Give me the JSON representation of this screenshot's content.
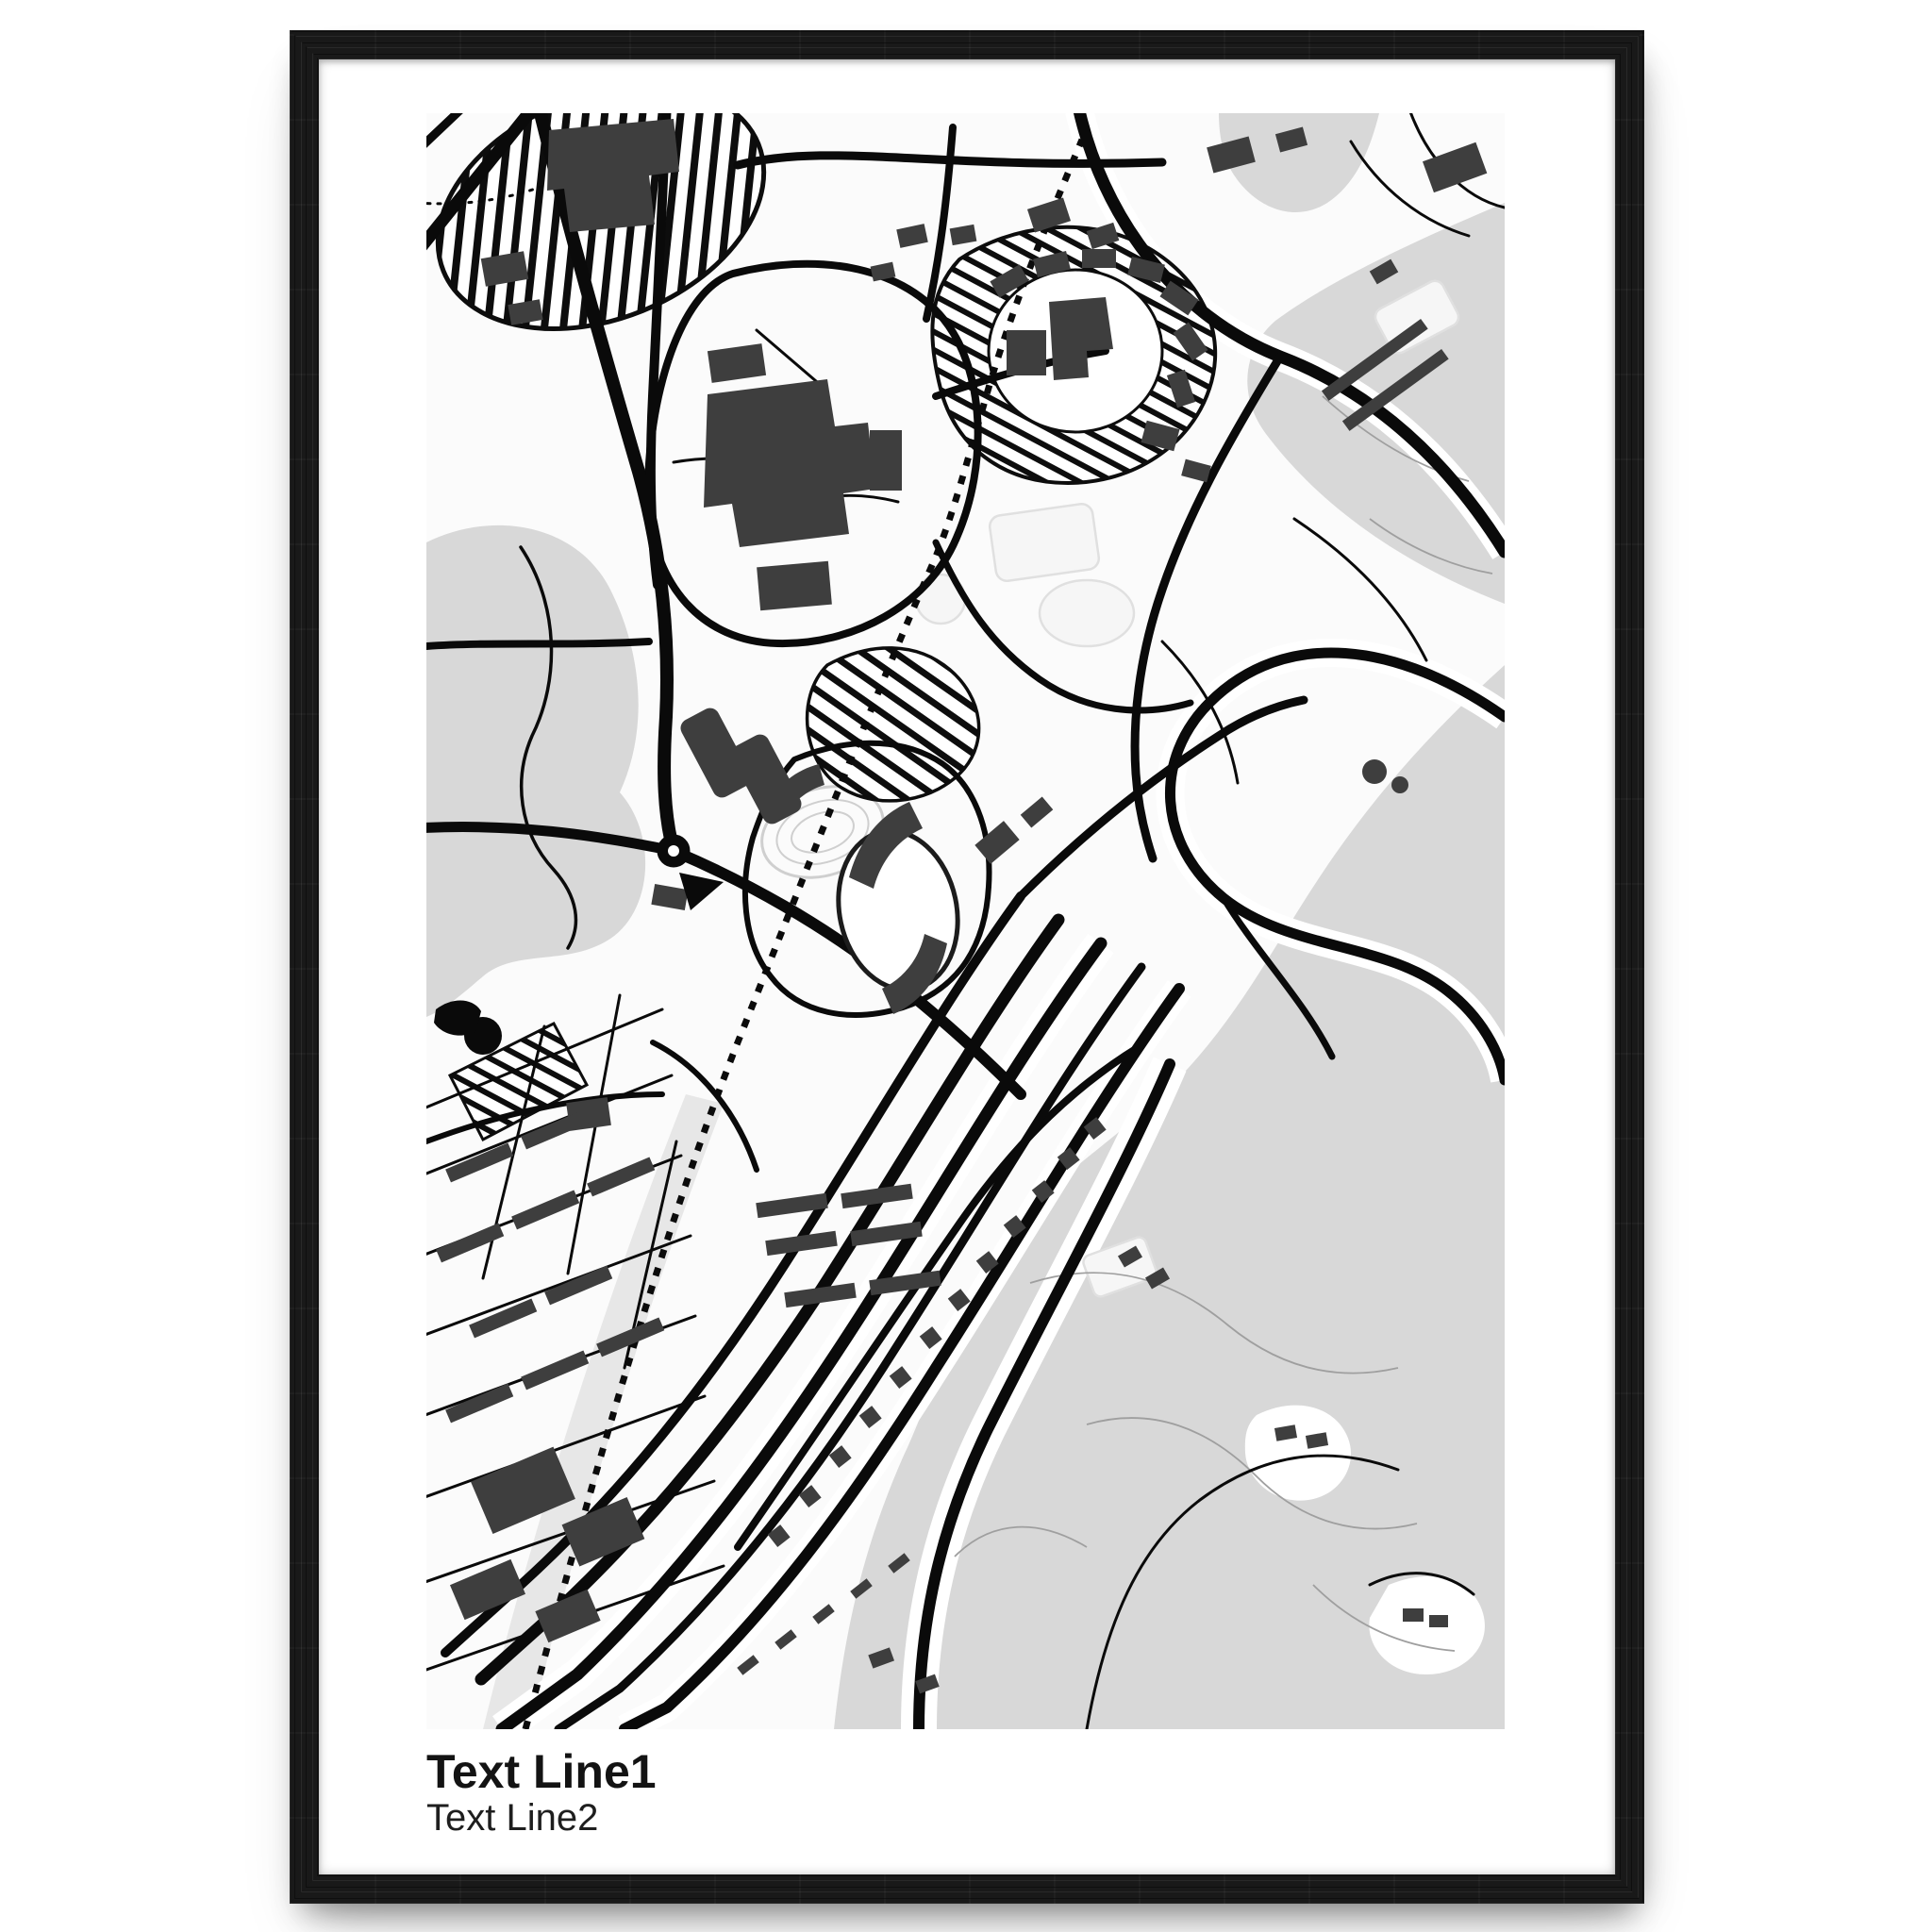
{
  "poster": {
    "caption": {
      "line1": "Text Line1",
      "line2": "Text Line2"
    },
    "frame": {
      "style": "black wood",
      "color": "#161616"
    },
    "palette": {
      "white": "#ffffff",
      "map_background": "#fbfbfb",
      "water": "#d8d8d8",
      "water_light": "#e7e7e7",
      "park": "#f6f6f6",
      "field_outline": "#e0e0e0",
      "track_ring": "#cfcfcf",
      "contour": "#9f9f9f",
      "road": "#0a0a0a",
      "railway": "#0b0b0b",
      "hatch": "#0d0d0d",
      "building": "#3e3e3e",
      "text": "#131313"
    }
  }
}
